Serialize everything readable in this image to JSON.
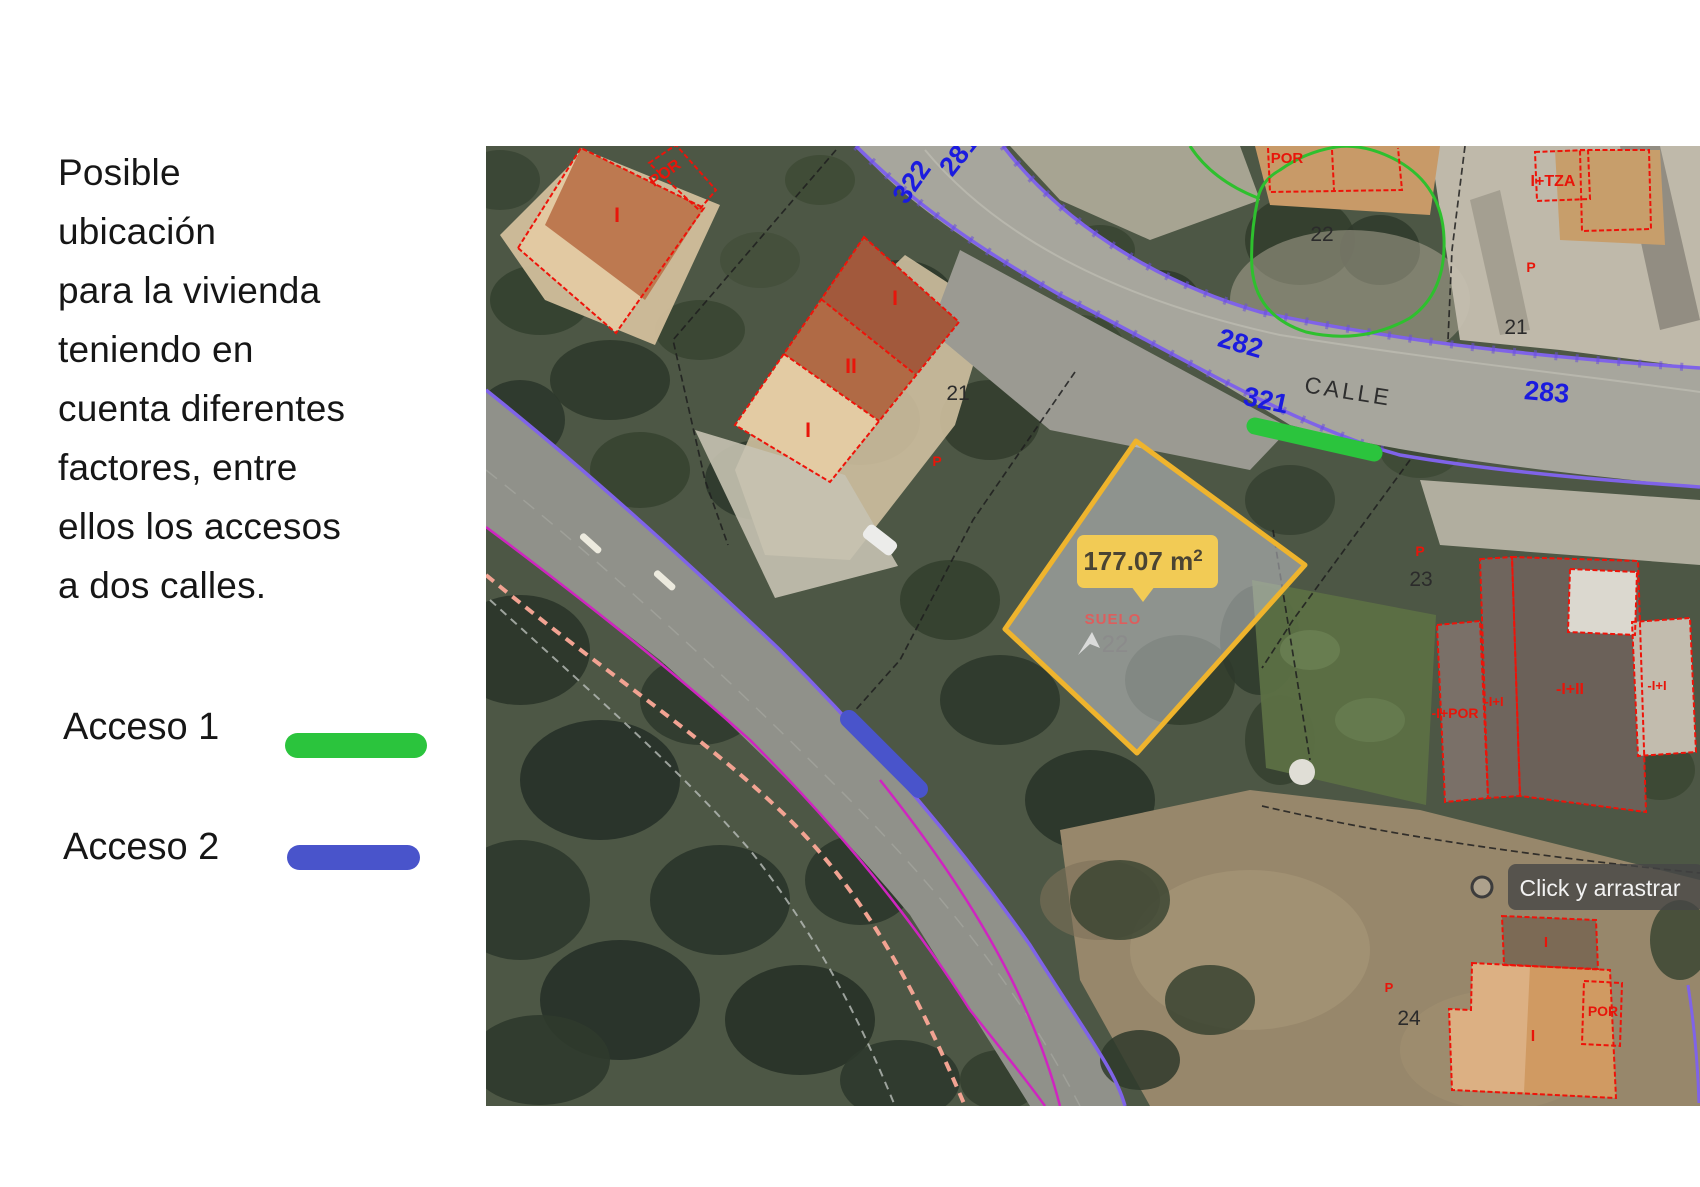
{
  "panel": {
    "paragraph_lines": [
      "Posible",
      "ubicación",
      "para la vivienda",
      "teniendo en",
      "cuenta diferentes",
      "factores, entre",
      "ellos los accesos",
      "a dos calles."
    ],
    "legend": [
      {
        "label": "Acceso 1",
        "color": "#2bc43d"
      },
      {
        "label": "Acceso 2",
        "color": "#4954cb"
      }
    ]
  },
  "map": {
    "street_name": "CALLE",
    "parcel_tooltip": {
      "value": "177.07 m",
      "superscript": "2"
    },
    "drag_tooltip_label": "Click y arrastrar",
    "street_numbers": [
      {
        "text": "281"
      },
      {
        "text": "322"
      },
      {
        "text": "282"
      },
      {
        "text": "321"
      },
      {
        "text": "283"
      }
    ],
    "parcel_numbers": [
      {
        "text": "21"
      },
      {
        "text": "22"
      },
      {
        "text": "21"
      },
      {
        "text": "23"
      },
      {
        "text": "24"
      },
      {
        "text": "22"
      }
    ],
    "cadastral_labels": [
      {
        "text": "POR"
      },
      {
        "text": "I"
      },
      {
        "text": "I"
      },
      {
        "text": "II"
      },
      {
        "text": "I"
      },
      {
        "text": "P"
      },
      {
        "text": "POR"
      },
      {
        "text": "I+TZA"
      },
      {
        "text": "P"
      },
      {
        "text": "P"
      },
      {
        "text": "-I+POR"
      },
      {
        "text": "-I+I"
      },
      {
        "text": "-I+II"
      },
      {
        "text": "-I+I"
      },
      {
        "text": "I"
      },
      {
        "text": "I"
      },
      {
        "text": "POR"
      },
      {
        "text": "P"
      },
      {
        "text": "SUELO"
      }
    ],
    "colors": {
      "access1": "#2bc43d",
      "access2": "#4954cb",
      "parcel_highlight": "#efb42d",
      "street_number_blue": "#1b1bdf",
      "cadastral_red": "#e8150a",
      "contour_green": "#2ec02e",
      "road_edge_purple": "#7f63e8",
      "boundary_magenta": "#cf25c0"
    }
  }
}
